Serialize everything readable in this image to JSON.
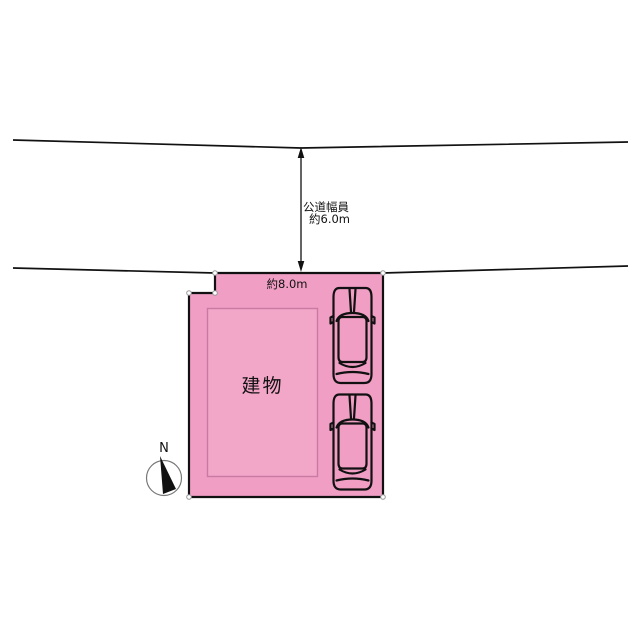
{
  "diagram": {
    "type": "site-plan",
    "road": {
      "width_label_line1": "公道幅員",
      "width_label_line2": "約6.0m"
    },
    "plot": {
      "frontage_label": "約8.0m",
      "building_label": "建物",
      "parking_spaces": 2
    },
    "compass": {
      "north_label": "N"
    },
    "colors": {
      "plot_fill": "#f09ec4",
      "building_fill": "#f2a6c8",
      "building_stroke": "#c97aa2",
      "line_black": "#111111",
      "compass_ring": "#777777"
    }
  }
}
